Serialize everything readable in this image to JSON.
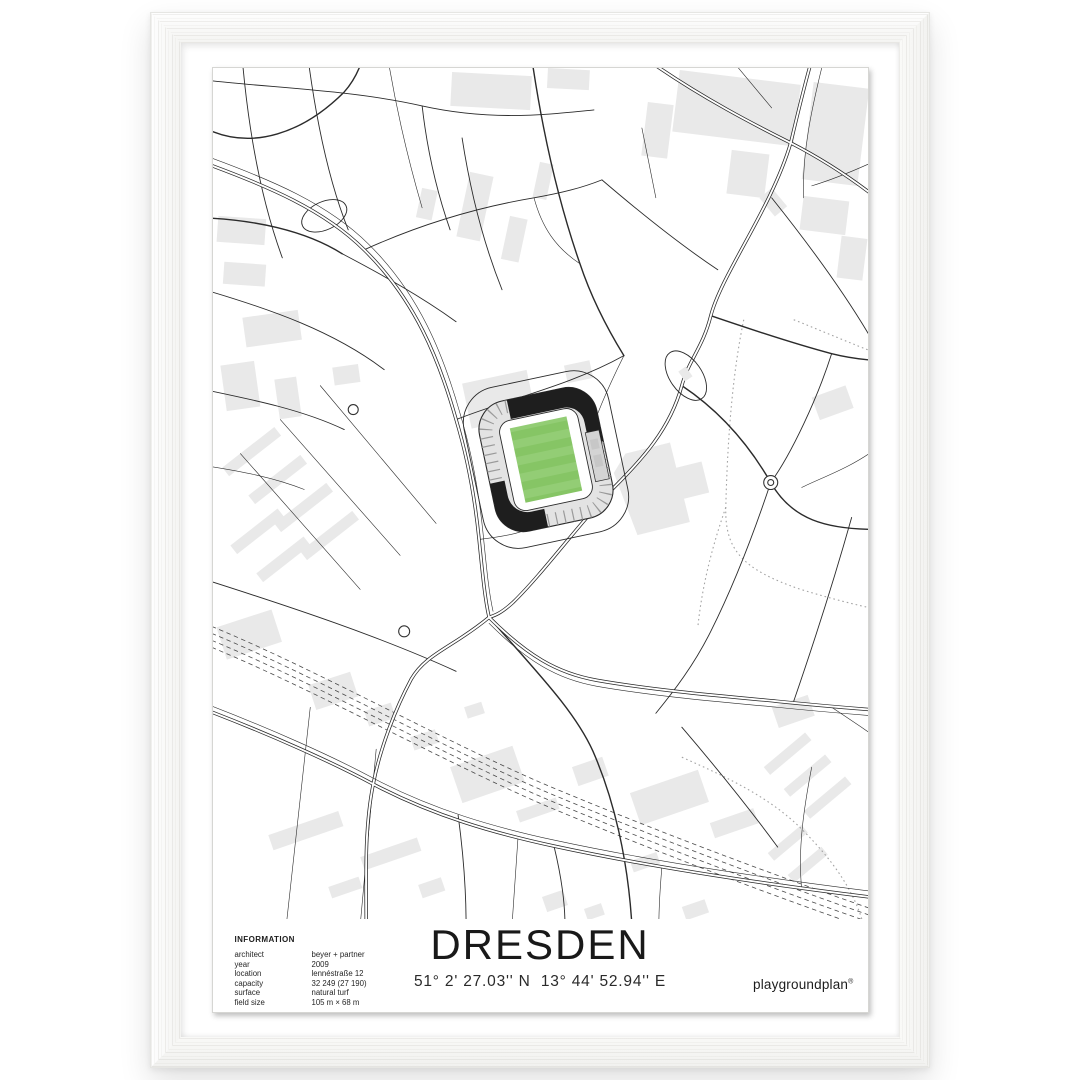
{
  "poster": {
    "title": "DRESDEN",
    "coordinates": "51° 2' 27.03'' N  13° 44' 52.94'' E",
    "brand": {
      "name": "playgroundplan",
      "mark": "®"
    },
    "information": {
      "heading": "INFORMATION",
      "rows": [
        {
          "label": "architect",
          "value": "beyer + partner"
        },
        {
          "label": "year",
          "value": "2009"
        },
        {
          "label": "location",
          "value": "lennéstraße 12"
        },
        {
          "label": "capacity",
          "value": "32 249 (27 190)"
        },
        {
          "label": "surface",
          "value": "natural turf"
        },
        {
          "label": "field size",
          "value": "105 m × 68 m"
        }
      ]
    }
  },
  "colors": {
    "pitch_green": "#86C565",
    "pitch_stripe": "#93CD75",
    "road": "#2b2b2b",
    "building": "#e9e9e9",
    "stand_dark": "#1e1e1e",
    "stand_light": "#e3e3e3",
    "rail": "#4a4a4a",
    "trail": "#a3a3a3",
    "paper": "#ffffff",
    "frame_wood": "#fbfbf9",
    "text": "#1d1d1d"
  }
}
